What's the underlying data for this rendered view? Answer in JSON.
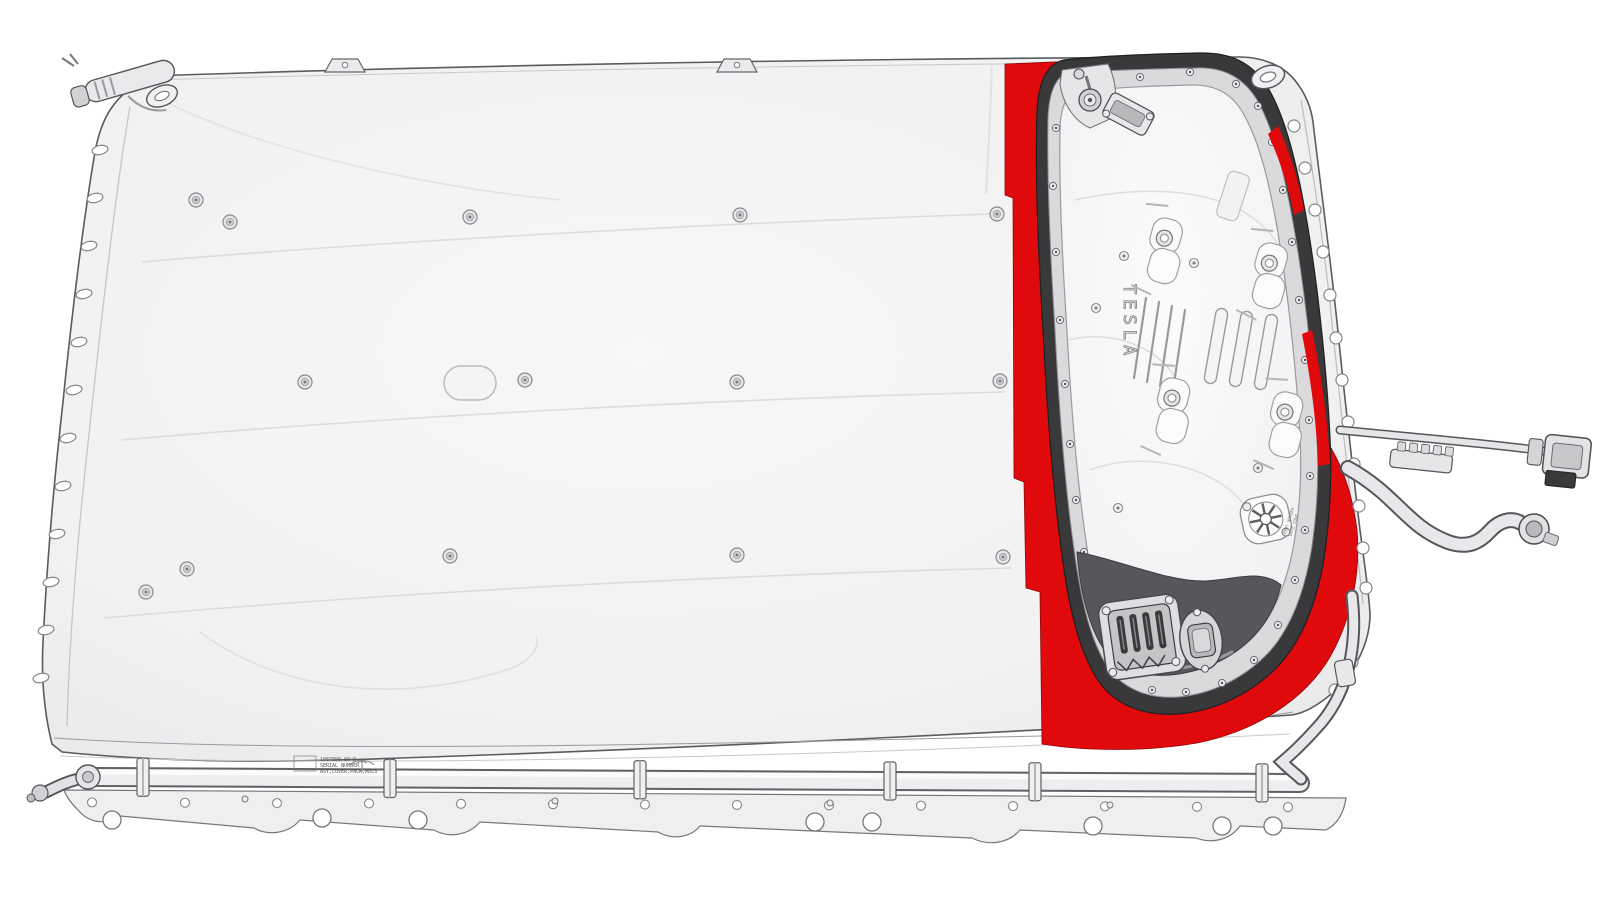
{
  "illustration": {
    "highlight_color": "#e00a0c",
    "penthouse": {
      "brand_text": "TESLA",
      "vent_note_line1": "PART NUMBER",
      "vent_note_line2": "DATE CODE"
    },
    "serial_label": {
      "line1": "1087890-0X D",
      "line2": "SERIAL NUMBER",
      "line3": "ASY,COVER,PACK,MDLS"
    }
  }
}
